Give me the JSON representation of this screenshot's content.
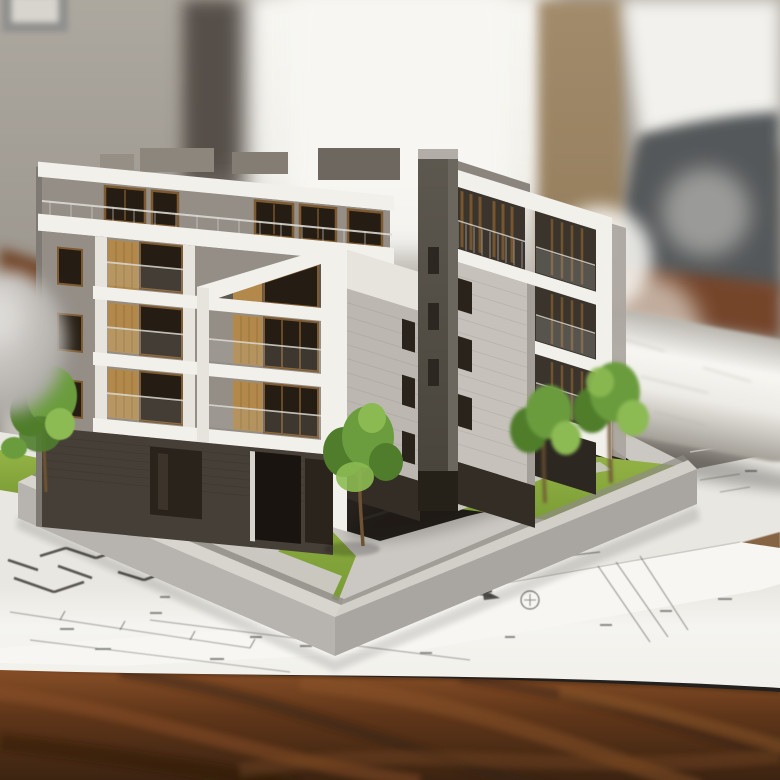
{
  "scene": {
    "type": "photograph",
    "description": "Architectural scale model of a modern white-and-grey multi-storey apartment building with wooden window panels, balconies, small trees and a lawn on a grey base platform, standing on unrolled blueprint floor plans on a dark polished wooden desk; blurred office background with a bright window, a tan curtain, a framed picture and a dark office chair; a rolled-up blueprint lies to the right.",
    "objects": [
      {
        "name": "building-model",
        "label": "apartment building scale model"
      },
      {
        "name": "model-base",
        "label": "grey model base with lawn and walkways"
      },
      {
        "name": "blueprint-sheets",
        "label": "floor plan drawings"
      },
      {
        "name": "blueprint-roll",
        "label": "rolled-up blueprint"
      },
      {
        "name": "desk",
        "label": "dark wooden desk"
      },
      {
        "name": "office-chair",
        "label": "blurred office chair"
      },
      {
        "name": "window-light",
        "label": "bright window in background"
      },
      {
        "name": "trees",
        "label": "miniature model trees"
      }
    ]
  },
  "palette": {
    "bg_wall": "#a39e96",
    "bg_wall_dark": "#8d8780",
    "pic_frame": "#90908e",
    "window_light": "#f5f4f0",
    "dark_band": "#564f48",
    "curtain": "#a28b6b",
    "chair": "#54585a",
    "wood_dark": "#3f2817",
    "wood_mid": "#6b3d1f",
    "wood_light": "#8c5527",
    "paper": "#f4f3ef",
    "paper_shade": "#e3e1dc",
    "ink": "#3e3c39",
    "base_top": "#cbc8c3",
    "wall_top": "#d8d5cf",
    "base_face_l": "#b7b4af",
    "base_face_r": "#a9a6a1",
    "lawn": "#86a73f",
    "lawn_light": "#9ab84a",
    "pave_dark": "#26211c",
    "foliage_d": "#4f7d2c",
    "foliage": "#6b9c3d",
    "foliage_l": "#8cba52",
    "trunk": "#6d5233",
    "white_bright": "#f2f0eb",
    "white_soft": "#e7e4de",
    "bld_gray": "#948e87",
    "bld_gray_d": "#7f7973",
    "siding": "#bcb8b1",
    "siding_l": "#c6c2bb",
    "tower": "#57524a",
    "tower_l": "#6b665e",
    "dark_recess": "#3a342c",
    "darker": "#272119",
    "wood_panel": "#b2894a",
    "win_frame": "#7e5a30",
    "win_dark": "#251d14",
    "glass": "#ccd1d3",
    "rail_white": "#dcd9d3"
  }
}
